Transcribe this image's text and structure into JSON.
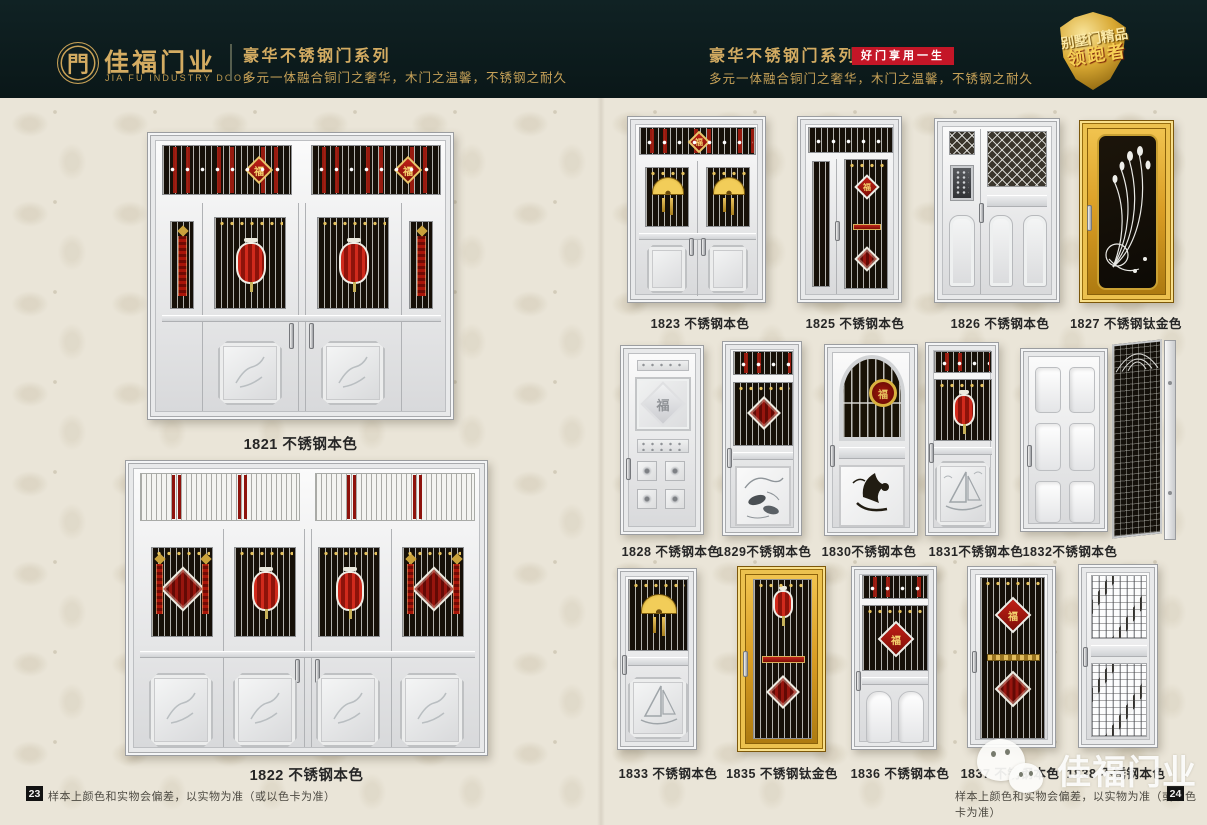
{
  "header": {
    "logo": {
      "glyph": "門",
      "brand": "佳福门业",
      "brand_en": "JIA FU INDUSTRY DOOR"
    },
    "left_series": {
      "title": "豪华不锈钢门系列",
      "subtitle": "多元一体融合铜门之奢华，木门之温馨，不锈钢之耐久"
    },
    "right_series": {
      "title": "豪华不锈钢门系列",
      "badge": "好门享用一生",
      "subtitle": "多元一体融合铜门之奢华，木门之温馨，不锈钢之耐久"
    },
    "shield": {
      "line1": "别墅门精品",
      "line2": "领跑者"
    }
  },
  "left_page": {
    "doors": [
      {
        "label": "1821 不锈钢本色"
      },
      {
        "label": "1822 不锈钢本色"
      }
    ],
    "footer": {
      "page": "23",
      "note": "样本上颜色和实物会偏差，以实物为准（或以色卡为准）"
    }
  },
  "right_page": {
    "row1": [
      {
        "label": "1823 不锈钢本色"
      },
      {
        "label": "1825 不锈钢本色"
      },
      {
        "label": "1826 不锈钢本色"
      },
      {
        "label": "1827 不锈钢钛金色"
      }
    ],
    "row2": [
      {
        "label": "1828 不锈钢本色"
      },
      {
        "label": "1829不锈钢本色"
      },
      {
        "label": "1830不锈钢本色"
      },
      {
        "label": "1831不锈钢本色"
      },
      {
        "label": "1832不锈钢本色"
      }
    ],
    "row3": [
      {
        "label": "1833 不锈钢本色"
      },
      {
        "label": "1835 不锈钢钛金色"
      },
      {
        "label": "1836 不锈钢本色"
      },
      {
        "label": "1837 不锈钢本色"
      },
      {
        "label": "1838 不锈钢本色"
      }
    ],
    "footer": {
      "page": "24",
      "note": "样本上颜色和实物会偏差，以实物为准（或以色卡为准）"
    }
  },
  "watermark": {
    "text": "佳福门业"
  },
  "ornaments": {
    "fu": "福"
  },
  "colors": {
    "header_bg": "#0c1c1d",
    "gold": "#d4ac62",
    "badge_red": "#c41627",
    "body_bg": "#eae5d8",
    "accent_red": "#9b150c",
    "titanium_gold": "#d99d24"
  }
}
